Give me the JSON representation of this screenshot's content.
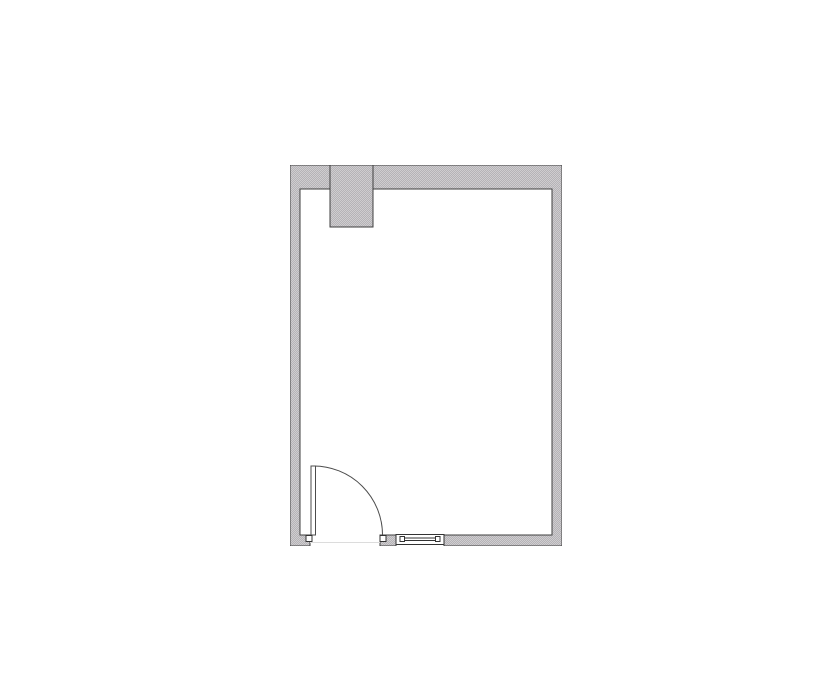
{
  "app": {
    "type": "floor-plan-drawing",
    "visible_text": []
  },
  "palette": {
    "page_background": "#ffffff",
    "wall_fill_light": "#cfcdcf",
    "wall_fill_dark": "#b5b3b7",
    "wall_outline": "#3f3f3f",
    "door_line": "#4c4c4c",
    "fixture_outline": "#333333",
    "fixture_fill": "#ffffff",
    "threshold_line": "#dcdcdc"
  },
  "floorplan": {
    "canvas_size_px": {
      "width": 835,
      "height": 678
    },
    "room": {
      "outer_rect_px": {
        "x": 290,
        "y": 165,
        "width": 272,
        "height": 381
      },
      "wall_thickness_px": {
        "top": 24,
        "left": 10,
        "right": 10,
        "bottom": 11
      }
    },
    "elements": [
      {
        "name": "column-projection",
        "type": "wall-projection",
        "rect_px": {
          "x": 330,
          "y": 165,
          "width": 43,
          "height": 62
        },
        "attached_to": "top-wall"
      },
      {
        "name": "door",
        "type": "hinged-door",
        "wall": "bottom-wall",
        "opening_px": {
          "x": 310,
          "y": 535,
          "width": 70
        },
        "hinge_side": "left",
        "swing": "into-room",
        "leaf_rect_px": {
          "x": 311,
          "y": 466,
          "width": 4.5,
          "height": 69
        },
        "swing_arc_radius_px": 69,
        "jamb_blocks_px": [
          {
            "x": 306,
            "y": 535.5,
            "width": 6,
            "height": 6
          },
          {
            "x": 380,
            "y": 535.5,
            "width": 6,
            "height": 6
          }
        ]
      },
      {
        "name": "window",
        "type": "window",
        "wall": "bottom-wall",
        "rect_px": {
          "x": 396,
          "y": 534.5,
          "width": 48,
          "height": 10
        },
        "mullion_blocks": 2,
        "glass_lines": 2
      }
    ]
  }
}
